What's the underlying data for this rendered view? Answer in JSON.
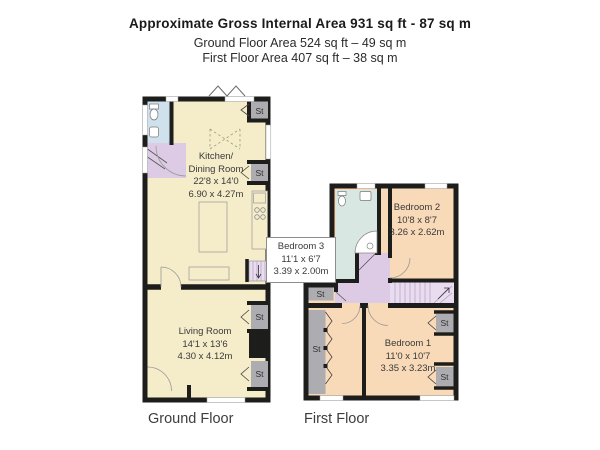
{
  "header": {
    "title": "Approximate Gross Internal Area 931 sq ft - 87 sq m",
    "ground_floor_area": "Ground Floor Area 524 sq ft – 49 sq m",
    "first_floor_area": "First Floor Area 407 sq ft – 38 sq m"
  },
  "ground_floor": {
    "caption": "Ground Floor",
    "rooms": {
      "kitchen_dining": {
        "name_line1": "Kitchen/",
        "name_line2": "Dining Room",
        "dims_imperial": "22'8 x 14'0",
        "dims_metric": "6.90 x 4.27m"
      },
      "living_room": {
        "name": "Living Room",
        "dims_imperial": "14'1 x 13'6",
        "dims_metric": "4.30 x 4.12m"
      }
    },
    "storage_labels": [
      "St",
      "St",
      "St",
      "St"
    ]
  },
  "first_floor": {
    "caption": "First Floor",
    "rooms": {
      "bedroom_2": {
        "name": "Bedroom 2",
        "dims_imperial": "10'8 x 8'7",
        "dims_metric": "3.26 x 2.62m"
      },
      "bedroom_3": {
        "name": "Bedroom 3",
        "dims_imperial": "11'1 x 6'7",
        "dims_metric": "3.39 x 2.00m"
      },
      "bedroom_1": {
        "name": "Bedroom 1",
        "dims_imperial": "11'0 x 10'7",
        "dims_metric": "3.35 x 3.23m"
      }
    },
    "storage_labels": [
      "St",
      "St",
      "St",
      "St"
    ]
  },
  "colors": {
    "wall": "#1d1d1b",
    "kitchen_living_fill": "#f5ecca",
    "bedroom_fill": "#f8d9b8",
    "bathroom_gf_fill": "#cfe1ec",
    "bathroom_ff_fill": "#d8e7e1",
    "hall_fill": "#ddcbe5",
    "stairs_fill": "#e9dbf0",
    "storage_fill": "#adacb0"
  }
}
